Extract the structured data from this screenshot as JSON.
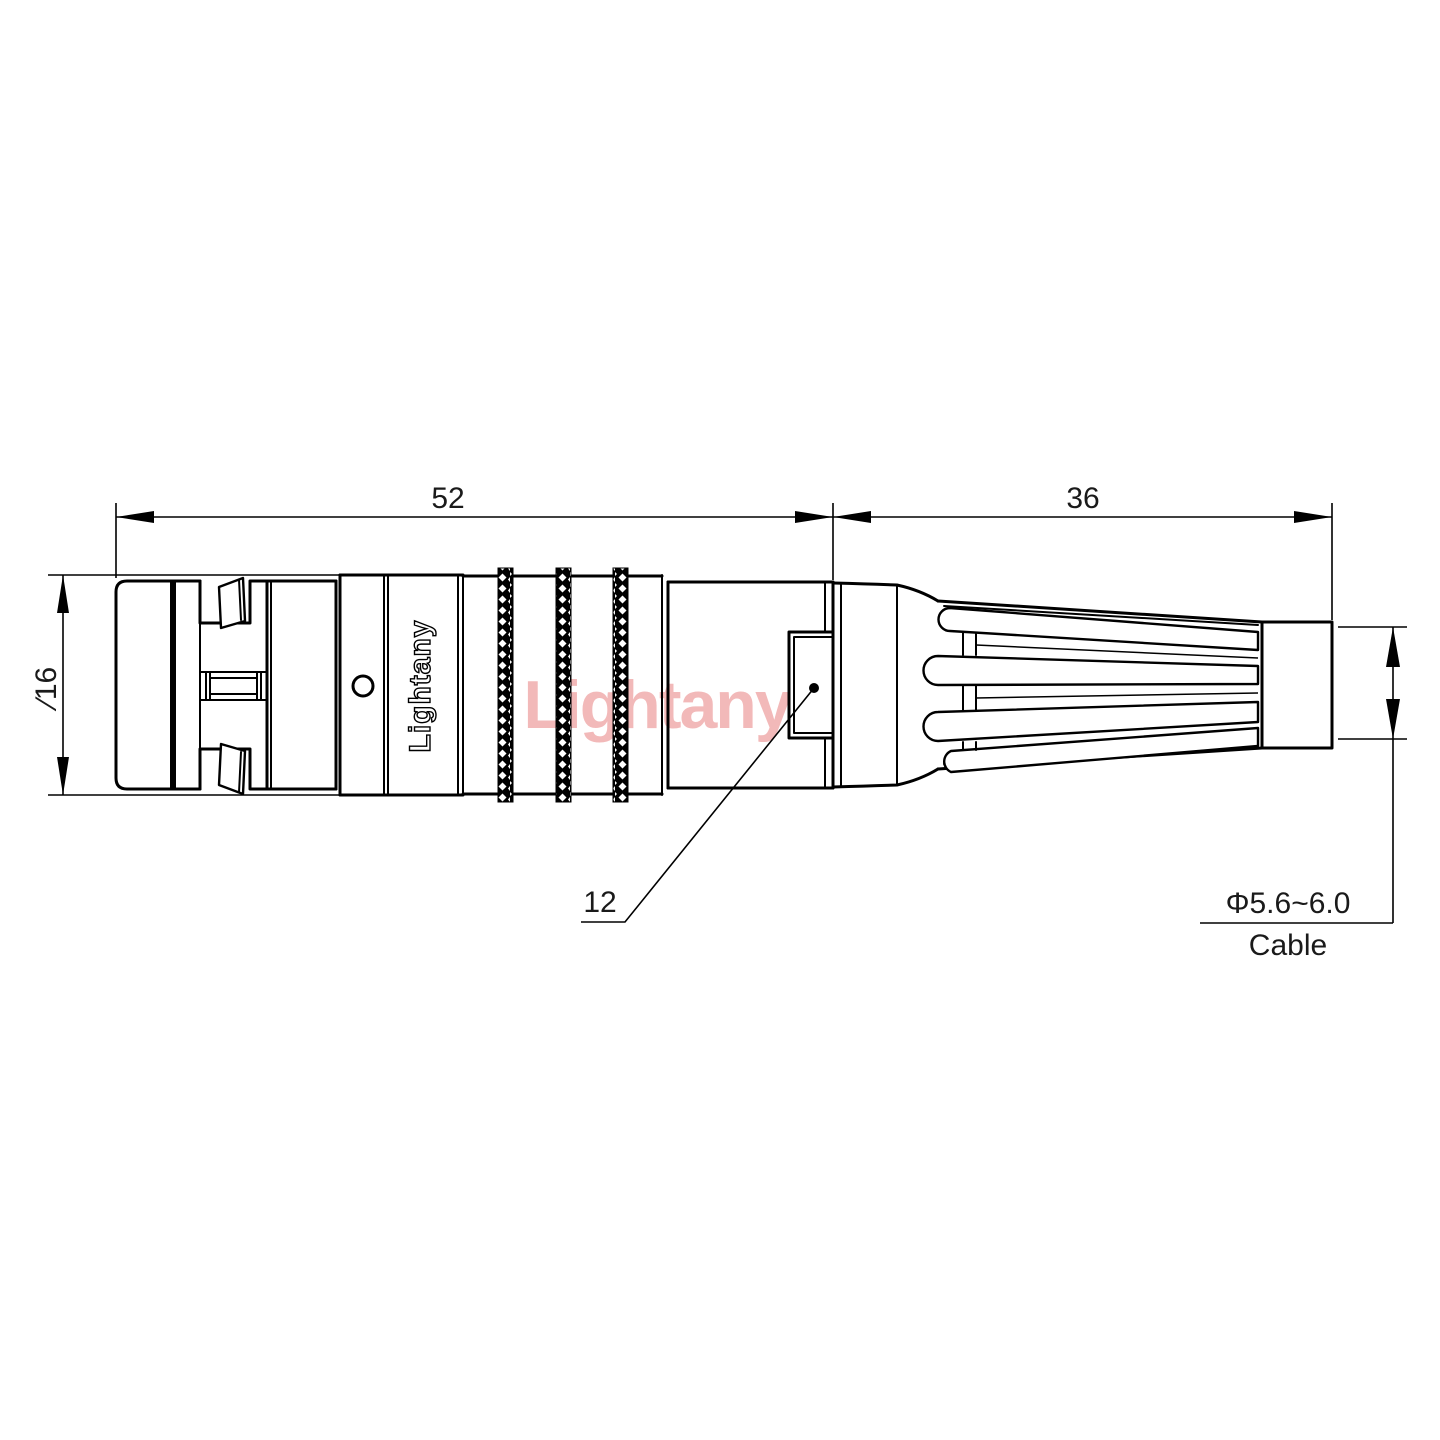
{
  "page": {
    "background": "#ffffff",
    "kind": "technical-drawing",
    "subject": "Circular push-pull connector with cable strain relief, side elevation"
  },
  "drawing": {
    "colors": {
      "line": "#000000",
      "dimension_text": "#1a1a1a",
      "watermark": "#f0a8a8"
    },
    "labels": {
      "body_length": "52",
      "boot_length": "36",
      "front_diameter": "∕16",
      "key_diameter": "12",
      "cable_diameter": "Φ5.6~6.0",
      "cable_word": "Cable",
      "brand": "Lightany",
      "watermark": "Lightany"
    }
  }
}
